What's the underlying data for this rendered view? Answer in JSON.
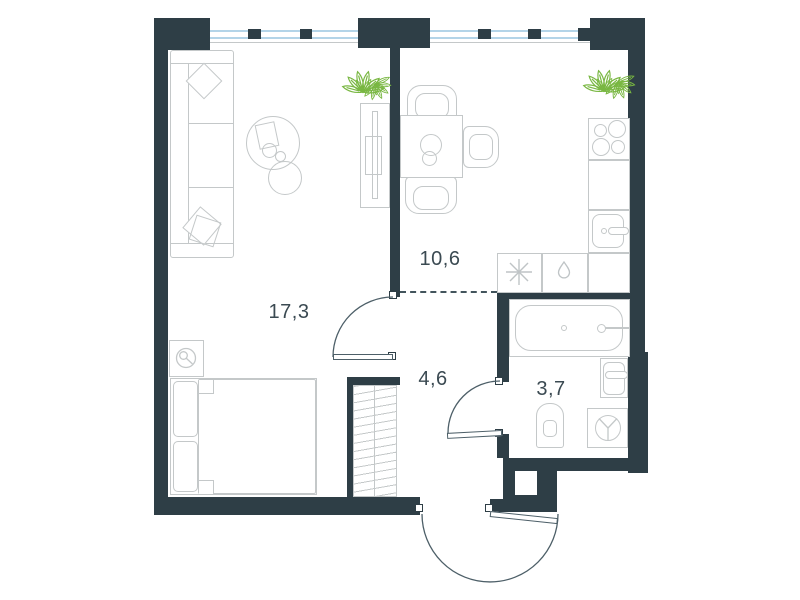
{
  "plan": {
    "title": "one-bedroom apartment floor plan",
    "rooms": [
      {
        "id": "living-room",
        "area_label": "17,3"
      },
      {
        "id": "kitchen",
        "area_label": "10,6"
      },
      {
        "id": "hallway",
        "area_label": "4,6"
      },
      {
        "id": "bathroom",
        "area_label": "3,7"
      }
    ],
    "colors": {
      "wall": "#2e3e46",
      "furniture_line": "#c4c8c9",
      "door_line": "#4d5f68",
      "window_glass": "#b3d4e8",
      "plant": "#79b742",
      "label_text": "#3b4a52",
      "background": "#ffffff"
    },
    "fixtures": [
      "sofa",
      "coffee-table",
      "tv-console",
      "plant",
      "bed",
      "nightstand-lamp",
      "wardrobe",
      "dining-table",
      "chair",
      "stove",
      "kitchen-sink",
      "appliance-freezer",
      "appliance-dishwasher",
      "bathtub",
      "bathroom-sink",
      "toilet",
      "washing-machine",
      "entrance-door",
      "interior-door",
      "window"
    ]
  }
}
